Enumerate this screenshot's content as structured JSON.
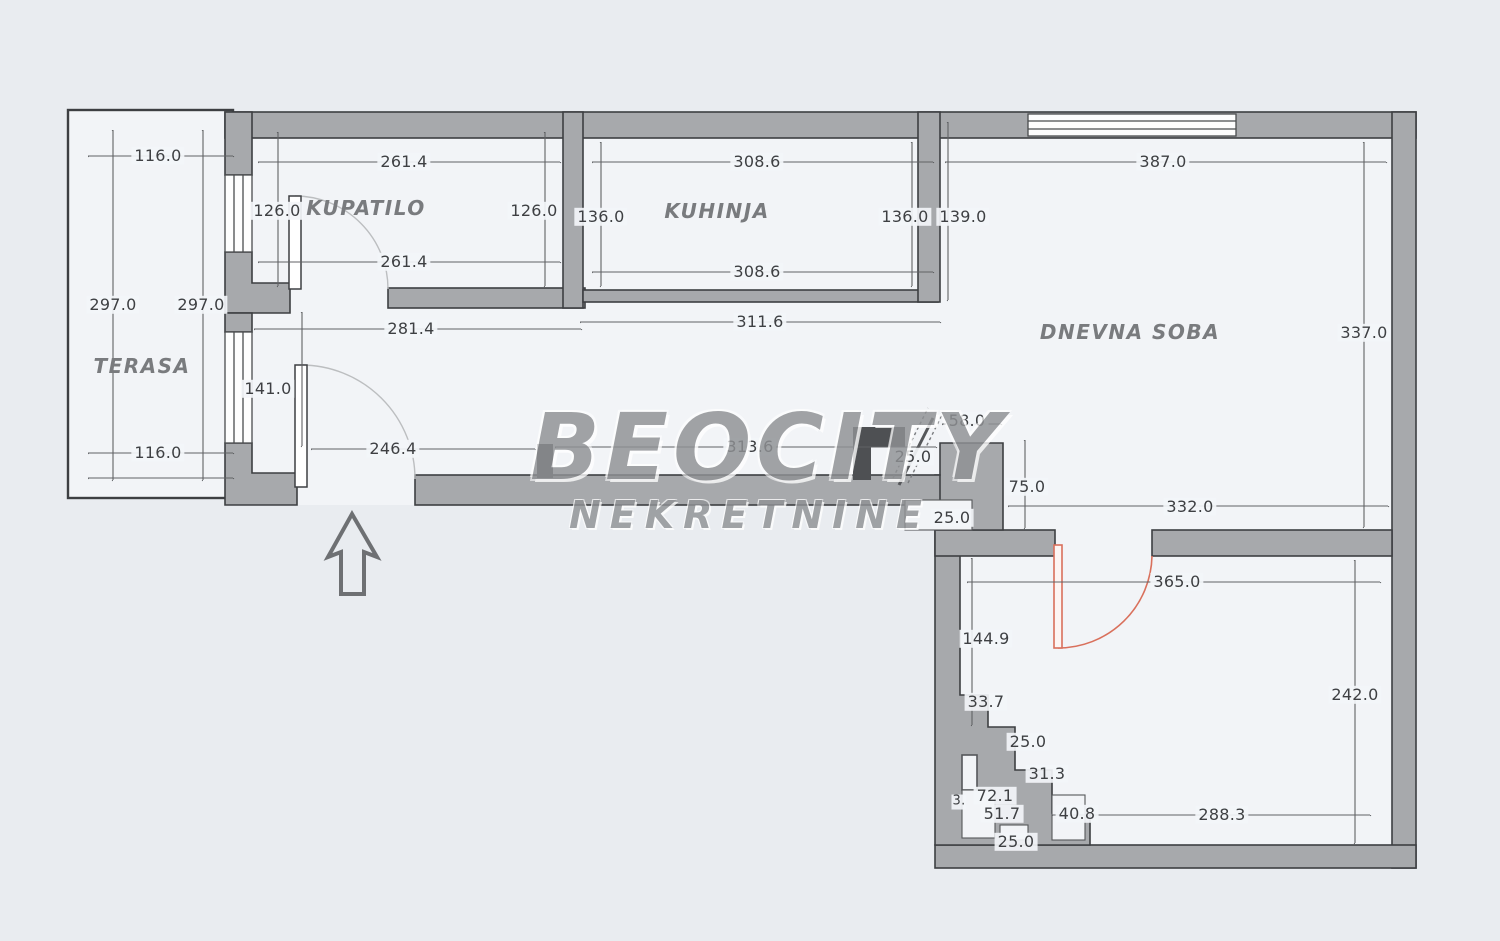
{
  "watermark": {
    "brand": "BEOCITY",
    "subtitle": "NEKRETNINE"
  },
  "rooms": {
    "terasa": "TERASA",
    "kupatilo": "KUPATILO",
    "kuhinja": "KUHINJA",
    "dnevna_soba": "DNEVNA SOBA"
  },
  "dims": {
    "terasa_top": "116.0",
    "terasa_bottom": "116.0",
    "terasa_left": "297.0",
    "terasa_right": "297.0",
    "kupatilo_top": "261.4",
    "kupatilo_bottom": "261.4",
    "kupatilo_left": "126.0",
    "kupatilo_right": "126.0",
    "kupatilo_outer": "281.4",
    "hall_door_height": "141.0",
    "hall_width_left": "246.4",
    "hall_width_right": "313.6",
    "kuhinja_top": "308.6",
    "kuhinja_bottom": "308.6",
    "kuhinja_left": "136.0",
    "kuhinja_right": "136.0",
    "kuhinja_outer_v": "139.0",
    "kuhinja_outer_h": "311.6",
    "dnevna_top": "387.0",
    "dnevna_right": "337.0",
    "opening_width": "58.0",
    "wall_25_upper": "25.0",
    "wall_75": "75.0",
    "wall_25_lower": "25.0",
    "dnevna_bottom": "332.0",
    "bedroom_top": "365.0",
    "bedroom_left": "144.9",
    "bedroom_right": "242.0",
    "bedroom_bottom": "288.3",
    "step_33": "33.7",
    "step_25_upper": "25.0",
    "step_31": "31.3",
    "step_72": "72.1",
    "step_3": "3.",
    "step_51": "51.7",
    "step_40": "40.8",
    "step_25_lower": "25.0"
  },
  "colors": {
    "wall_fill": "#a7a9ac",
    "wall_outline": "#3d3f42",
    "floor": "#f2f4f7",
    "background": "#e9ecf0",
    "door_arc_accent": "#d9705c",
    "dimension_line": "#606265",
    "watermark_gray": "#8f9194"
  }
}
